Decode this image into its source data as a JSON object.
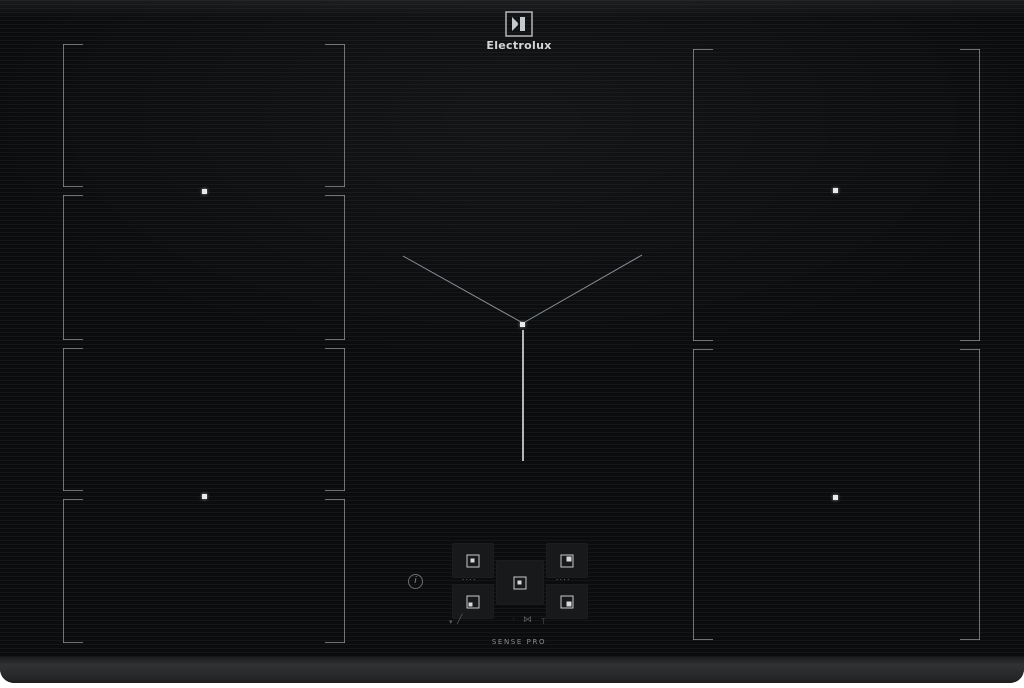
{
  "brand": {
    "wordmark": "Electrolux",
    "symbol_icon": "electrolux-mark"
  },
  "surface": {
    "glass_color": "#0a0c0e",
    "zone_marking_color": "#878d91",
    "bezel_color": "#27292b",
    "zones": [
      {
        "id": "left-rear-outer"
      },
      {
        "id": "left-rear-inner"
      },
      {
        "id": "left-front-inner"
      },
      {
        "id": "left-front-outer"
      },
      {
        "id": "right-rear"
      },
      {
        "id": "right-front"
      },
      {
        "id": "center-flex"
      }
    ]
  },
  "control_panel": {
    "info_glyph": "i",
    "separator_dots": "····",
    "range_label": "SENSE PRO",
    "zone_keys": [
      {
        "id": "left-rear-key",
        "icon": "zone-square-dot-center"
      },
      {
        "id": "left-front-key",
        "icon": "zone-square-dot-left"
      },
      {
        "id": "center-key",
        "icon": "zone-square-dot-center"
      },
      {
        "id": "right-rear-key",
        "icon": "zone-square-dot-top-right"
      },
      {
        "id": "right-front-key",
        "icon": "zone-square-dot-bottom-right"
      }
    ],
    "function_glyphs": {
      "pause": "▾",
      "slide": "╱",
      "dot": "·",
      "bridge": "⋈",
      "hood": "T"
    }
  }
}
